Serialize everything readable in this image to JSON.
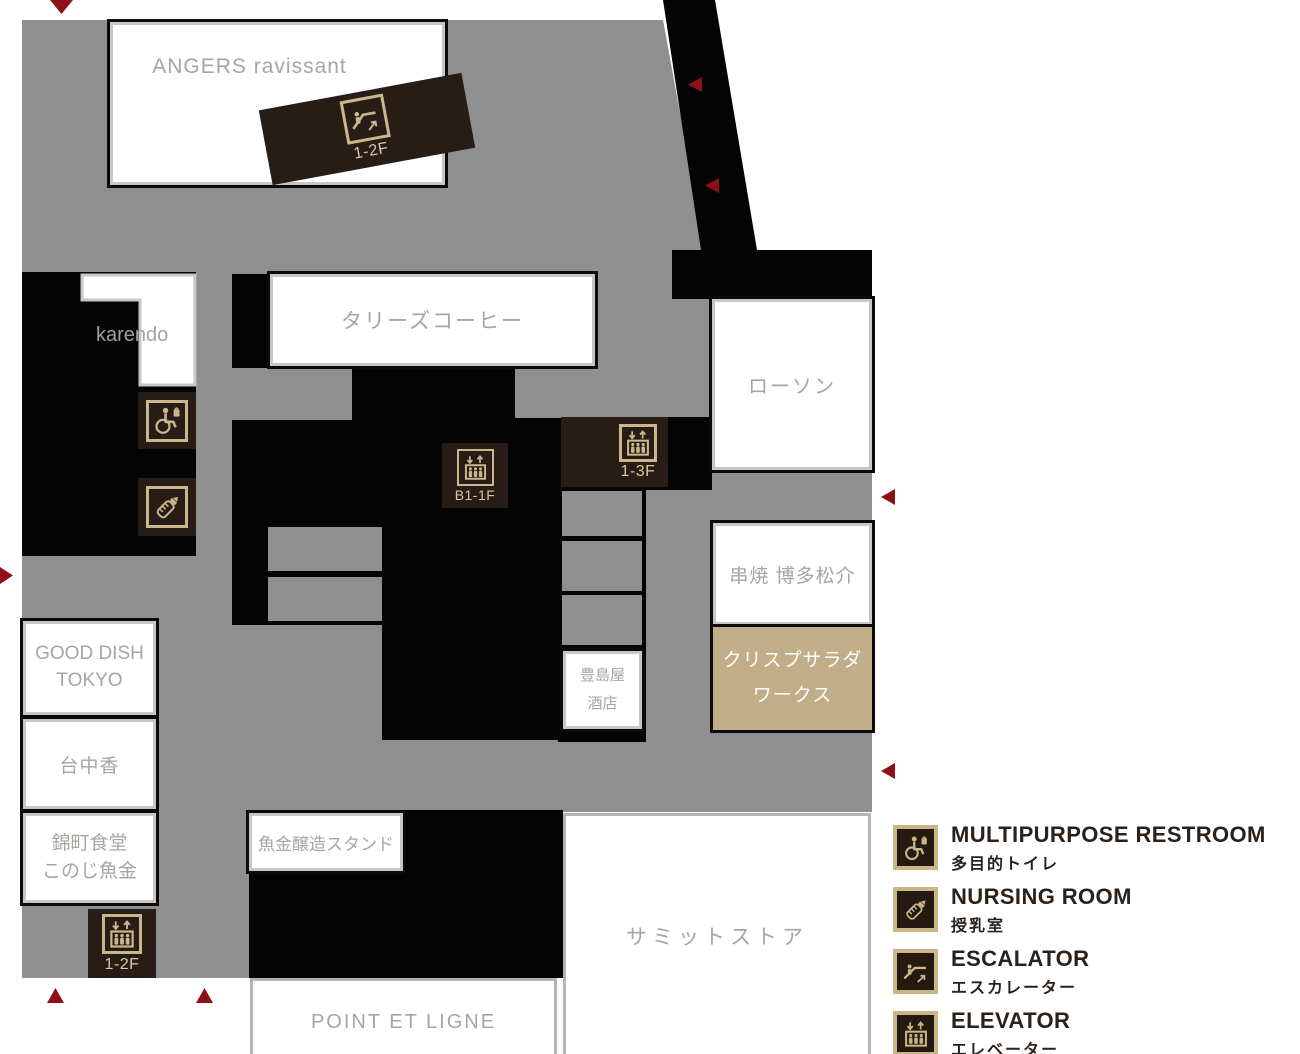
{
  "title": "floor-map-1f",
  "stores": {
    "angers": {
      "name": "ANGERS ravissant"
    },
    "karendo": {
      "name": "karendo"
    },
    "tullys": {
      "name": "タリーズコーヒー"
    },
    "lawson": {
      "name": "ローソン"
    },
    "kushiyaki": {
      "name": "串焼 博多松介"
    },
    "crisp": {
      "line1": "クリスプサラダ",
      "line2": "ワークス"
    },
    "toshimaya": {
      "line1": "豊島屋",
      "line2": "酒店"
    },
    "gooddish": {
      "line1": "GOOD DISH",
      "line2": "TOKYO"
    },
    "taichuka": {
      "name": "台中香"
    },
    "nishikicho": {
      "line1": "錦町食堂",
      "line2": "このじ魚金"
    },
    "uokin": {
      "name": "魚金醸造スタンド"
    },
    "summit": {
      "name": "サミットストア"
    },
    "point": {
      "name": "POINT ET LIGNE"
    }
  },
  "facilities": {
    "escalator_1_2f": {
      "label": "1-2F",
      "type": "escalator"
    },
    "elevator_b1_1f": {
      "label": "B1-1F",
      "type": "elevator"
    },
    "elevator_1_3f": {
      "label": "1-3F",
      "type": "elevator"
    },
    "elevator_1_2f": {
      "label": "1-2F",
      "type": "elevator"
    },
    "multipurpose_restroom": {
      "type": "wheelchair"
    },
    "nursing_room": {
      "type": "baby-bottle"
    }
  },
  "legend": {
    "items": [
      {
        "icon": "wheelchair-icon",
        "title": "MULTIPURPOSE RESTROOM",
        "subtitle": "多目的トイレ"
      },
      {
        "icon": "baby-bottle-icon",
        "title": "NURSING ROOM",
        "subtitle": "授乳室"
      },
      {
        "icon": "escalator-icon",
        "title": "ESCALATOR",
        "subtitle": "エスカレーター"
      },
      {
        "icon": "elevator-icon",
        "title": "ELEVATOR",
        "subtitle": "エレベーター"
      }
    ]
  },
  "colors": {
    "walkway_gray": "#8f8f8f",
    "structure_black": "#050404",
    "tile_brown": "#281d16",
    "icon_tan": "#cbb78b",
    "crisp_tan": "#c1ad87",
    "entrance_red": "#8e1019",
    "store_text_gray": "#a8a4a0",
    "legend_text": "#2b2118"
  }
}
